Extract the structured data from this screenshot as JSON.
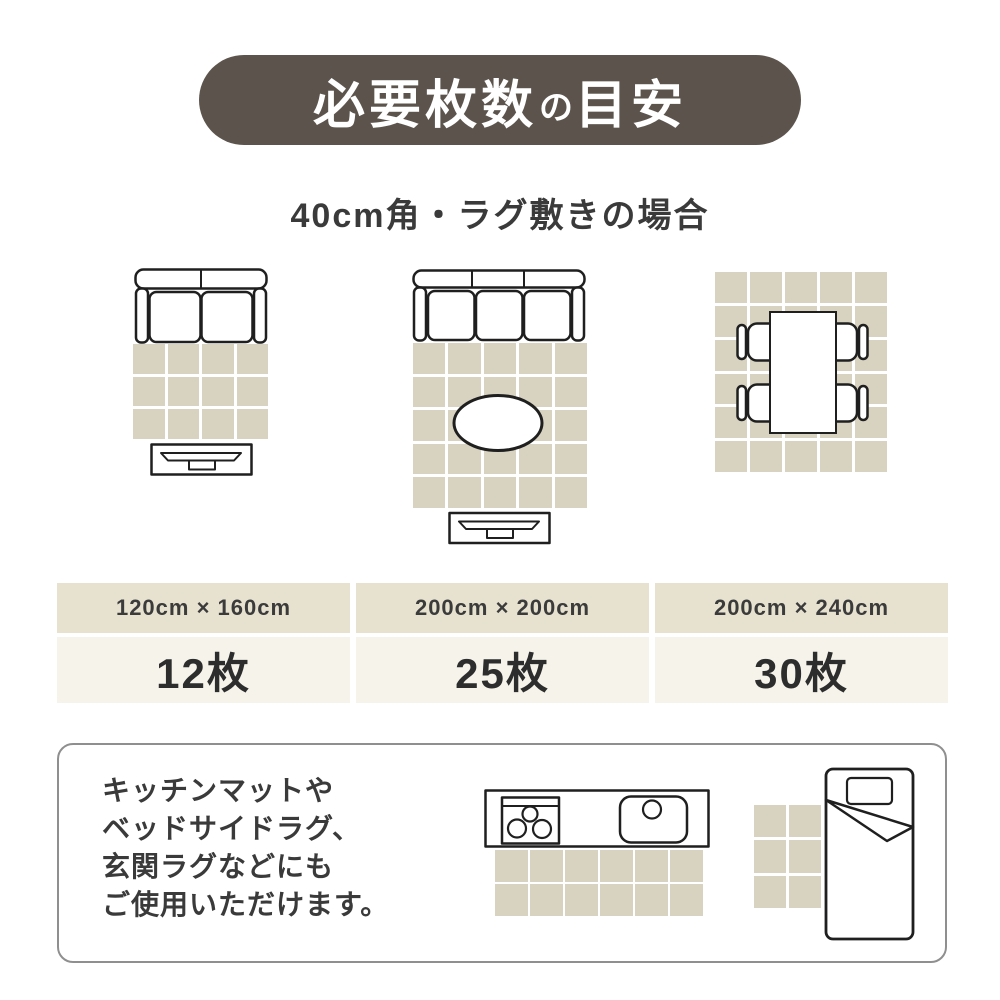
{
  "colors": {
    "pill-bg": "#5c544c",
    "tile": "#d8d2c0",
    "label-header-bg": "#e7e2cf",
    "label-value-bg": "#f5f3ea"
  },
  "header": {
    "title_main": "必要枚数",
    "title_particle": "の",
    "title_sub": "目安"
  },
  "subtitle": "40cm角・ラグ敷きの場合",
  "panels": [
    {
      "size": "120cm × 160cm",
      "count": "12枚",
      "grid": {
        "cols": 4,
        "rows": 3
      }
    },
    {
      "size": "200cm × 200cm",
      "count": "25枚",
      "grid": {
        "cols": 5,
        "rows": 5
      }
    },
    {
      "size": "200cm × 240cm",
      "count": "30枚",
      "grid": {
        "cols": 5,
        "rows": 6
      }
    }
  ],
  "note": {
    "lines": [
      "キッチンマットや",
      "ベッドサイドラグ、",
      "玄関ラグなどにも",
      "ご使用いただけます。"
    ],
    "kitchen_mat_grid": {
      "cols": 6,
      "rows": 2
    },
    "bedside_rug_grid": {
      "cols": 2,
      "rows": 3
    }
  }
}
